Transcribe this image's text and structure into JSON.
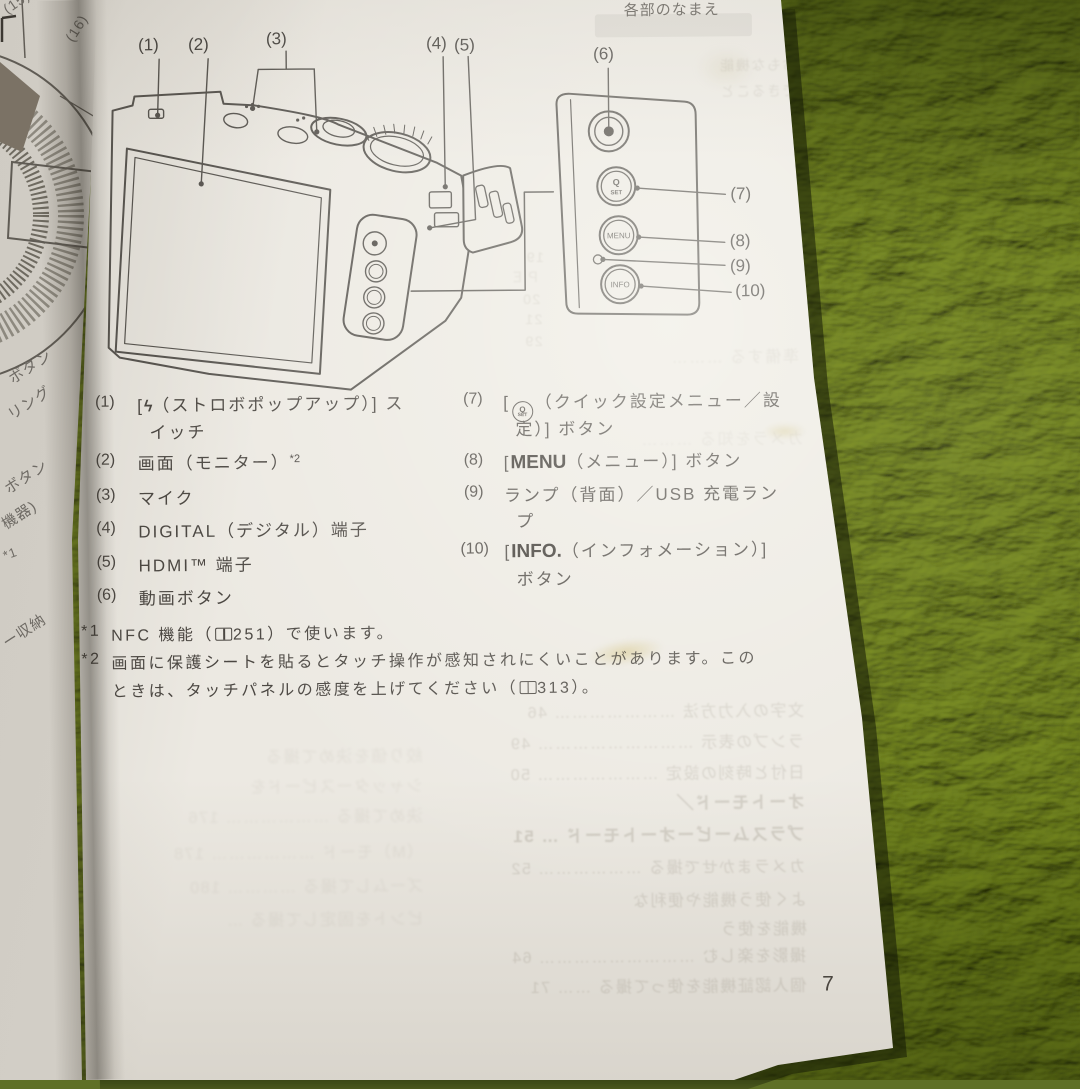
{
  "header": {
    "title": "各部のなまえ"
  },
  "page_number": "7",
  "figure": {
    "callouts": [
      "(1)",
      "(2)",
      "(3)",
      "(4)",
      "(5)",
      "(6)",
      "(7)",
      "(8)",
      "(9)",
      "(10)"
    ],
    "panel": {
      "q": "Q",
      "set": "SET",
      "menu": "MENU",
      "info": "INFO"
    }
  },
  "left_page": {
    "callouts": [
      "(15)",
      "(16)"
    ],
    "fragments": [
      "ボタン",
      "リング",
      "ボタン",
      "機器)",
      "*1",
      "ー収納"
    ]
  },
  "parts": {
    "p1": {
      "num": "(1)",
      "pre": "[",
      "bolt": "ϟ",
      "l1": "（ストロボポップアップ）] ス",
      "l2": "イッチ"
    },
    "p2": {
      "num": "(2)",
      "l1": "画面（モニター）",
      "sup": "*2"
    },
    "p3": {
      "num": "(3)",
      "l1": "マイク"
    },
    "p4": {
      "num": "(4)",
      "l1": "DIGITAL（デジタル）端子"
    },
    "p5": {
      "num": "(5)",
      "l1": "HDMI™ 端子"
    },
    "p6": {
      "num": "(6)",
      "l1": "動画ボタン"
    },
    "p7": {
      "num": "(7)",
      "pre": "[",
      "icon_q": "Q",
      "icon_set": "SET",
      "l1": "（クイック設定メニュー／設",
      "l2": "定）] ボタン"
    },
    "p8": {
      "num": "(8)",
      "pre": "[",
      "bold": "MENU",
      "post": "（メニュー）] ボタン"
    },
    "p9": {
      "num": "(9)",
      "l1": "ランプ（背面）／USB 充電ラン",
      "l2": "プ"
    },
    "p10": {
      "num": "(10)",
      "pre": "[",
      "bold": "INFO.",
      "post": "（インフォメーション）]",
      "l2": "ボタン"
    }
  },
  "footnotes": {
    "f1_mark": "*1",
    "f1_pre": "NFC 機能（",
    "f1_ref": "251",
    "f1_post": "）で使います。",
    "f2_mark": "*2",
    "f2_l1": "画面に保護シートを貼るとタッチ操作が感知されにくいことがあります。この",
    "f2_l2_pre": "ときは、タッチパネルの感度を上げてください（",
    "f2_ref": "313",
    "f2_post": "）。"
  },
  "ghosts": {
    "upper": [
      "19",
      "ＰＥ",
      "20",
      "21",
      "29"
    ],
    "mid": [
      "準備する ………",
      "カメラを知る ……… 35",
      "おもな機能",
      "できること"
    ],
    "lower": [
      "文字の入力方法 ………………… 46",
      "ランプの表示 ……………………… 49",
      "日付と時刻の設定 ………………… 50",
      "オートモード／",
      "プラスムービーオートモード … 51",
      "カメラまかせで撮る ……………… 52",
      "よく使う機能や便利な",
      "機能を使う",
      "撮影を楽しむ ……………………… 64",
      "個人認証機能を使って撮る …… 71"
    ],
    "leftcol": [
      "絞り値を決めて撮る",
      "シャッタースピードを",
      "決めて撮る ……………… 176",
      "（M）モード ……………… 178",
      "ズームして撮る ………… 180",
      "ピントを固定して撮る …"
    ]
  },
  "colors": {
    "paper": "#ece9e2",
    "carpet": "#76862f",
    "ink": "#4b4742",
    "ghost": "#c6c1b7"
  }
}
